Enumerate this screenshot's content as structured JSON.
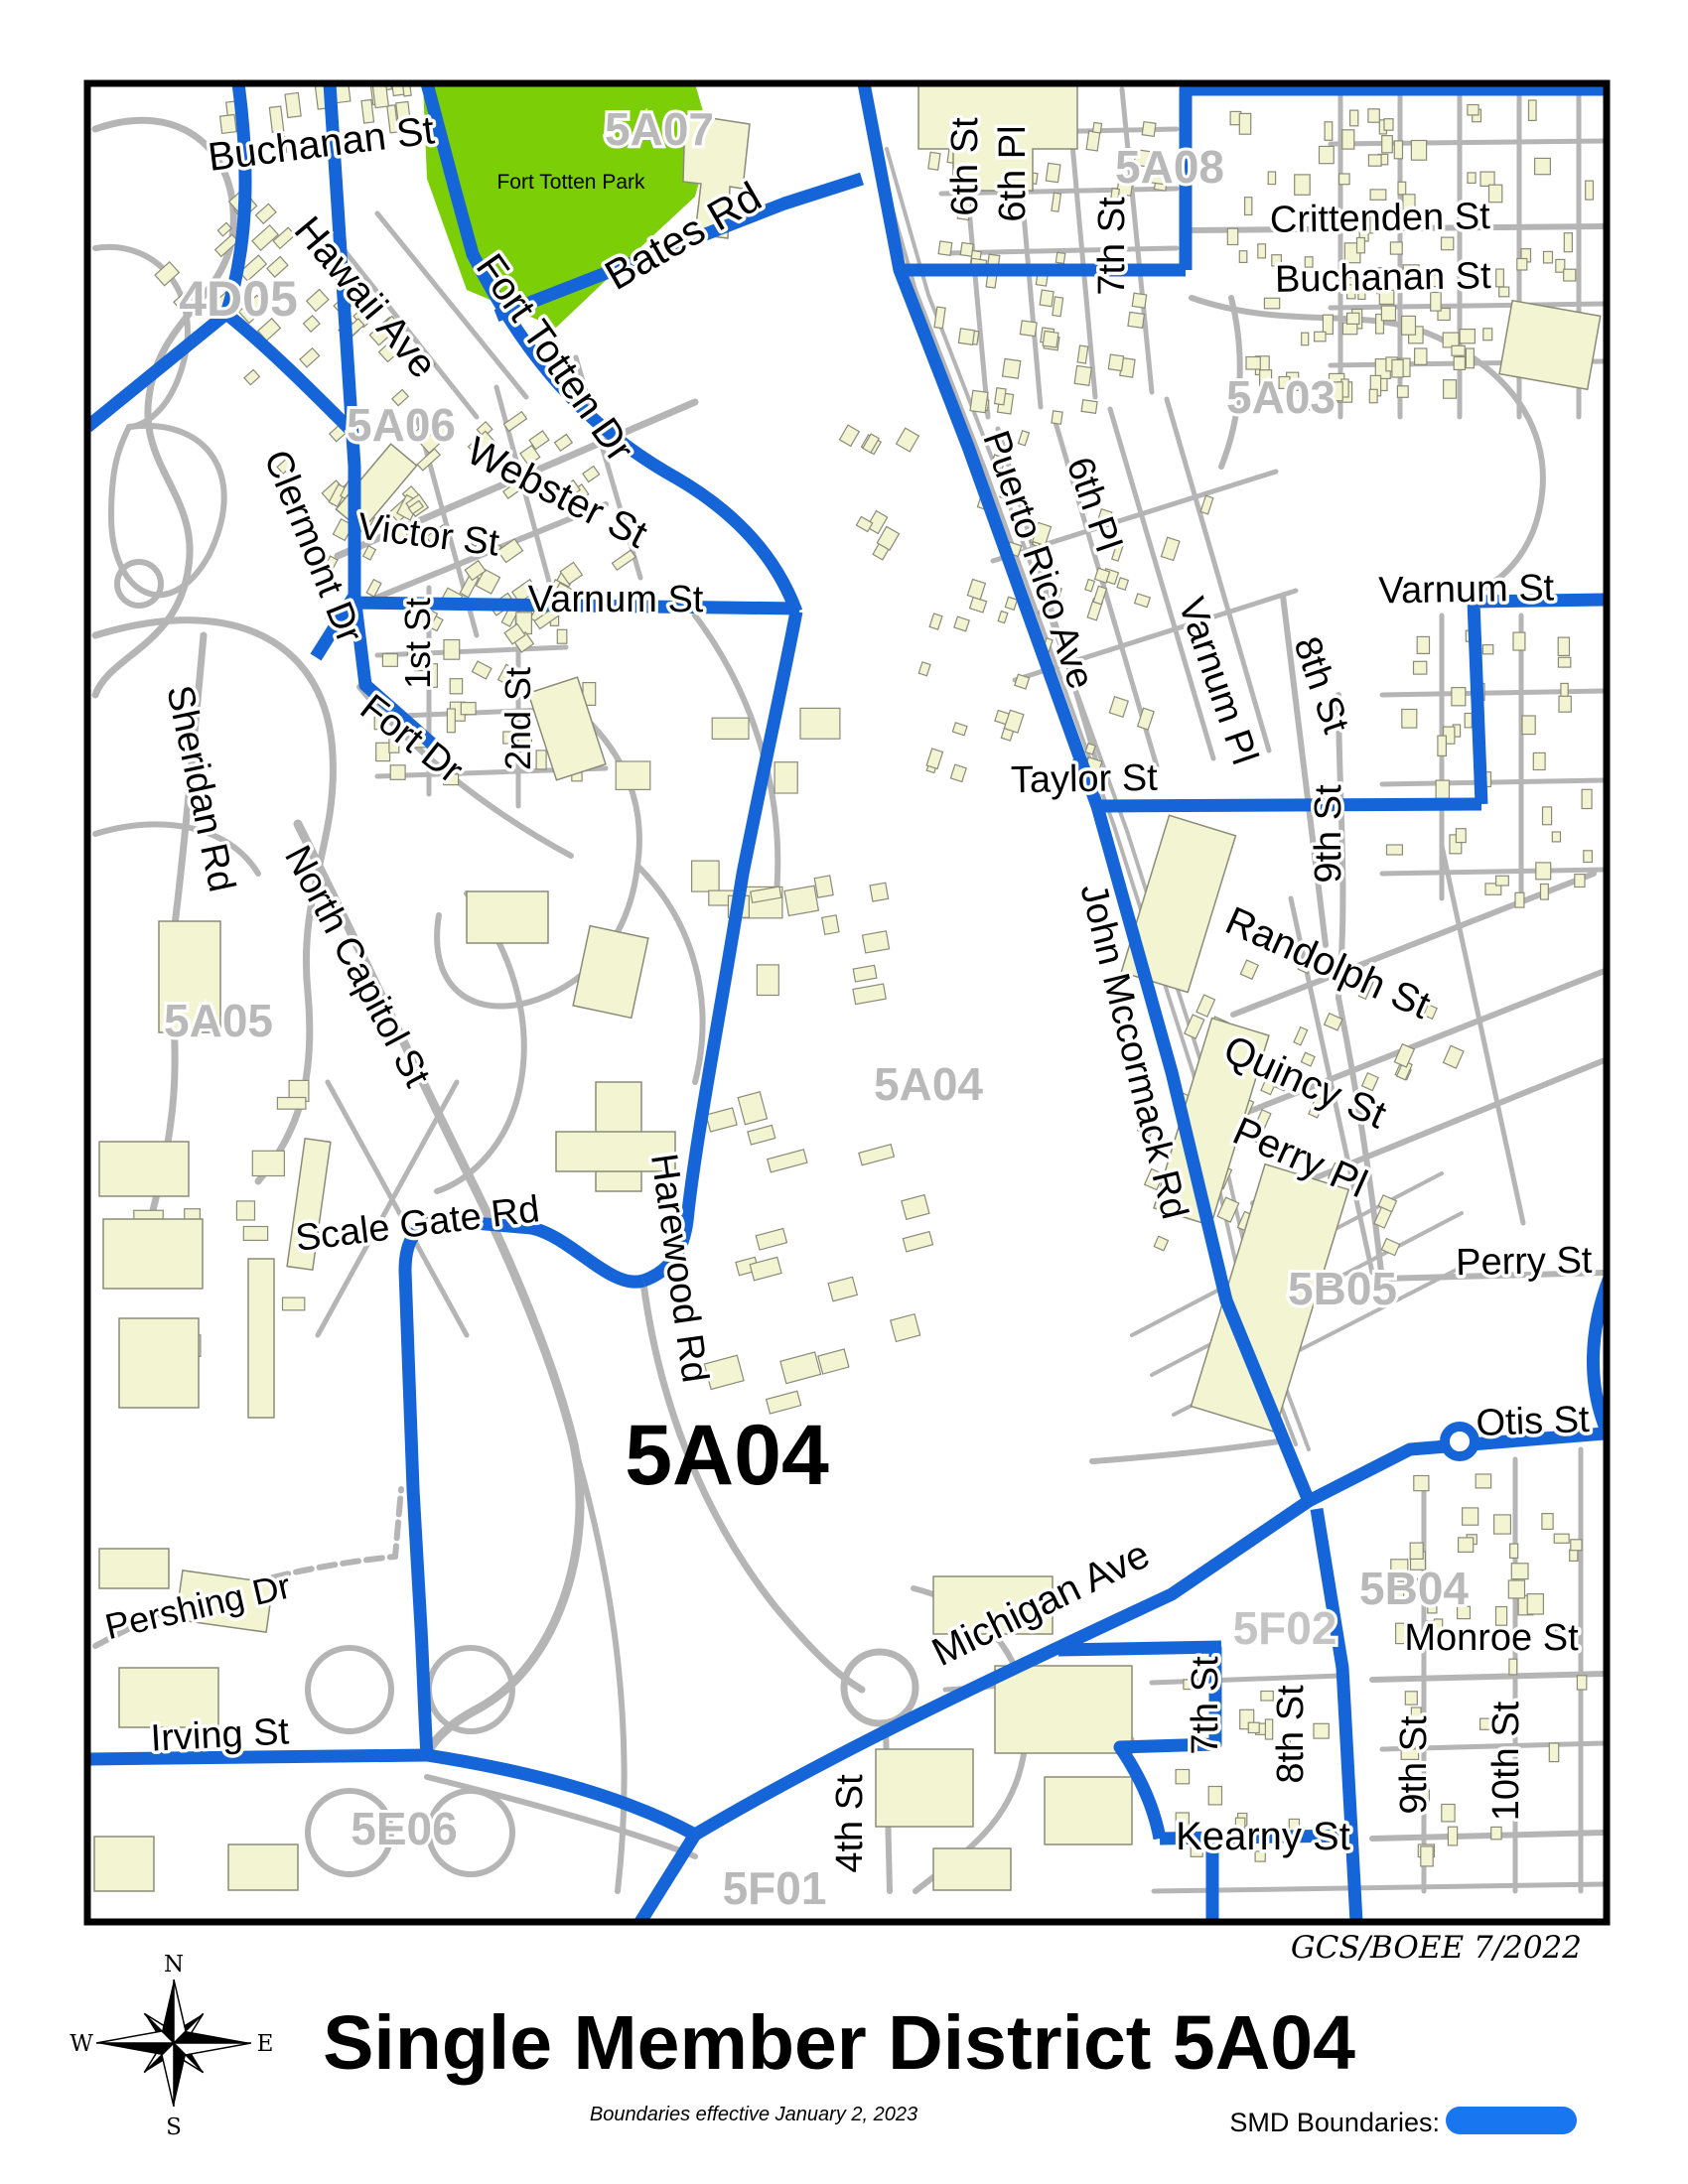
{
  "map": {
    "main_district_label": "5A04",
    "park": {
      "name": "Fort Totten Park",
      "color": "#7ccf06"
    },
    "districts": {
      "d4d05": "4D05",
      "d5a07": "5A07",
      "d5a08": "5A08",
      "d5a06": "5A06",
      "d5a03": "5A03",
      "d5a05": "5A05",
      "d5a04_small": "5A04",
      "d5b05": "5B05",
      "d5b04": "5B04",
      "d5f02": "5F02",
      "d5e06": "5E06",
      "d5f01": "5F01"
    },
    "streets": {
      "buchanan_nw": "Buchanan St",
      "hawaii": "Hawaii Ave",
      "fort_totten_dr": "Fort Totten Dr",
      "bates": "Bates Rd",
      "webster": "Webster St",
      "victor": "Victor St",
      "varnum_w": "Varnum St",
      "first_st": "1st St",
      "second_st": "2nd St",
      "clermont": "Clermont Dr",
      "fort_dr": "Fort Dr",
      "sheridan": "Sheridan Rd",
      "north_capitol": "North Capitol St",
      "scale_gate": "Scale Gate Rd",
      "harewood": "Harewood Rd",
      "pershing": "Pershing Dr",
      "irving": "Irving St",
      "fourth_st": "4th St",
      "sixth_st_top": "6th St",
      "sixth_pl_top": "6th Pl",
      "seventh_st_top": "7th St",
      "crittenden": "Crittenden St",
      "buchanan_ne": "Buchanan St",
      "puerto_rico": "Puerto Rico Ave",
      "sixth_pl_mid": "6th Pl",
      "varnum_pl": "Varnum Pl",
      "eighth_st_n": "8th St",
      "varnum_e": "Varnum St",
      "ninth_st_n": "9th St",
      "taylor": "Taylor St",
      "randolph": "Randolph St",
      "quincy": "Quincy St",
      "perry_pl": "Perry Pl",
      "perry_st": "Perry St",
      "john_mccormack": "John Mccormack Rd",
      "otis": "Otis St",
      "monroe": "Monroe St",
      "michigan": "Michigan Ave",
      "kearny": "Kearny St",
      "seventh_s": "7th St",
      "eighth_s": "8th St",
      "ninth_s": "9th St",
      "tenth_s": "10th St"
    },
    "colors": {
      "smd_boundary": "#1565d8",
      "legend_swatch": "#1877f0",
      "park_green": "#7ccf06",
      "building_fill": "#f3f5d2",
      "road_gray": "#b5b5b5",
      "district_gray": "#b9b9b9"
    }
  },
  "footer": {
    "title": "Single Member District 5A04",
    "credit": "GCS/BOEE 7/2022",
    "effective_note": "Boundaries effective January 2, 2023",
    "legend_label": "SMD Boundaries:",
    "compass": {
      "n": "N",
      "e": "E",
      "s": "S",
      "w": "W"
    }
  }
}
